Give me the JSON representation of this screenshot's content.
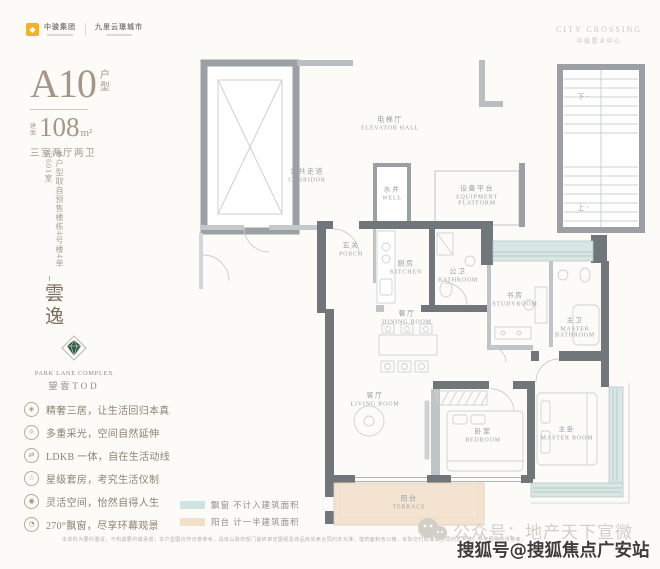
{
  "header": {
    "brand": {
      "name": "中骏集团",
      "tagline": "九里云璟城市"
    },
    "project": {
      "en": "CITY CROSSING",
      "cn": "中骏置业中心"
    }
  },
  "unit": {
    "type": "A10",
    "type_suffix": "户型",
    "area_prefix": "建面",
    "area_value": "108",
    "area_unit": "m²",
    "layout": "三室两厅两卫",
    "source_note": "本户型取自预售楼栋4号楼4单元601室",
    "series_name": "雲逸"
  },
  "project_logo": {
    "en": "PARK LANE COMPLEX",
    "cn": "望雲TOD"
  },
  "features": [
    {
      "icon": "gem-icon",
      "glyph": "◈",
      "text": "精奢三居，让生活回归本真"
    },
    {
      "icon": "sun-icon",
      "glyph": "☼",
      "text": "多重采光，空间自然延伸"
    },
    {
      "icon": "circulation-icon",
      "glyph": "⇄",
      "text": "LDKB 一体，自在生活动线"
    },
    {
      "icon": "star-icon",
      "glyph": "☆",
      "text": "星级套房，考究生活仪制"
    },
    {
      "icon": "eye-icon",
      "glyph": "◉",
      "text": "灵活空间，怡然自得人生"
    },
    {
      "icon": "baywindow-icon",
      "glyph": "◔",
      "text": "270°飘窗，尽享环幕观景"
    }
  ],
  "floorplan": {
    "rooms": [
      {
        "cn": "电梯厅",
        "en": "ELEVATOR HALL"
      },
      {
        "cn": "公共走道",
        "en": "CORRIDOR"
      },
      {
        "cn": "水井",
        "en": "WELL"
      },
      {
        "cn": "设备平台",
        "en": "EQUIPMENT PLATFORM"
      },
      {
        "cn": "玄关",
        "en": "PORCH"
      },
      {
        "cn": "厨房",
        "en": "KITCHEN"
      },
      {
        "cn": "公卫",
        "en": "BATHROOM"
      },
      {
        "cn": "书房",
        "en": "STUDYROOM"
      },
      {
        "cn": "主卫",
        "en": "MASTER BATHROOM"
      },
      {
        "cn": "餐厅",
        "en": "DINING ROOM"
      },
      {
        "cn": "客厅",
        "en": "LIVING ROOM"
      },
      {
        "cn": "卧室",
        "en": "BEDROOM"
      },
      {
        "cn": "主卧",
        "en": "MASTER ROOM"
      },
      {
        "cn": "阳台",
        "en": "TERRACE"
      }
    ],
    "stairs": {
      "down": "下 ·",
      "up": "上 ·"
    },
    "colors": {
      "wall": "#9aa0a3",
      "wall_dark": "#70767a",
      "bay_fill": "#d8e7e4",
      "terrace_fill": "#f4e3d0"
    }
  },
  "legend": [
    {
      "swatch_color": "#cfe4e0",
      "label": "飘窗 不计入建筑面积"
    },
    {
      "swatch_color": "#f2dfc9",
      "label": "阳台 计一半建筑面积"
    }
  ],
  "disclaimer": "本资料为要约邀请，不构成要约或承诺；本户型图仅作示意参考，具体以政府部门最终审定图纸及商品房买卖合同约定为准；建筑面积含公摊，实际交付标准以合同约定为准，部分图例仅供参考。",
  "watermarks": {
    "wechat_account": "公众号：地产天下宣微",
    "sohu_account": "搜狐号@搜狐焦点广安站"
  }
}
